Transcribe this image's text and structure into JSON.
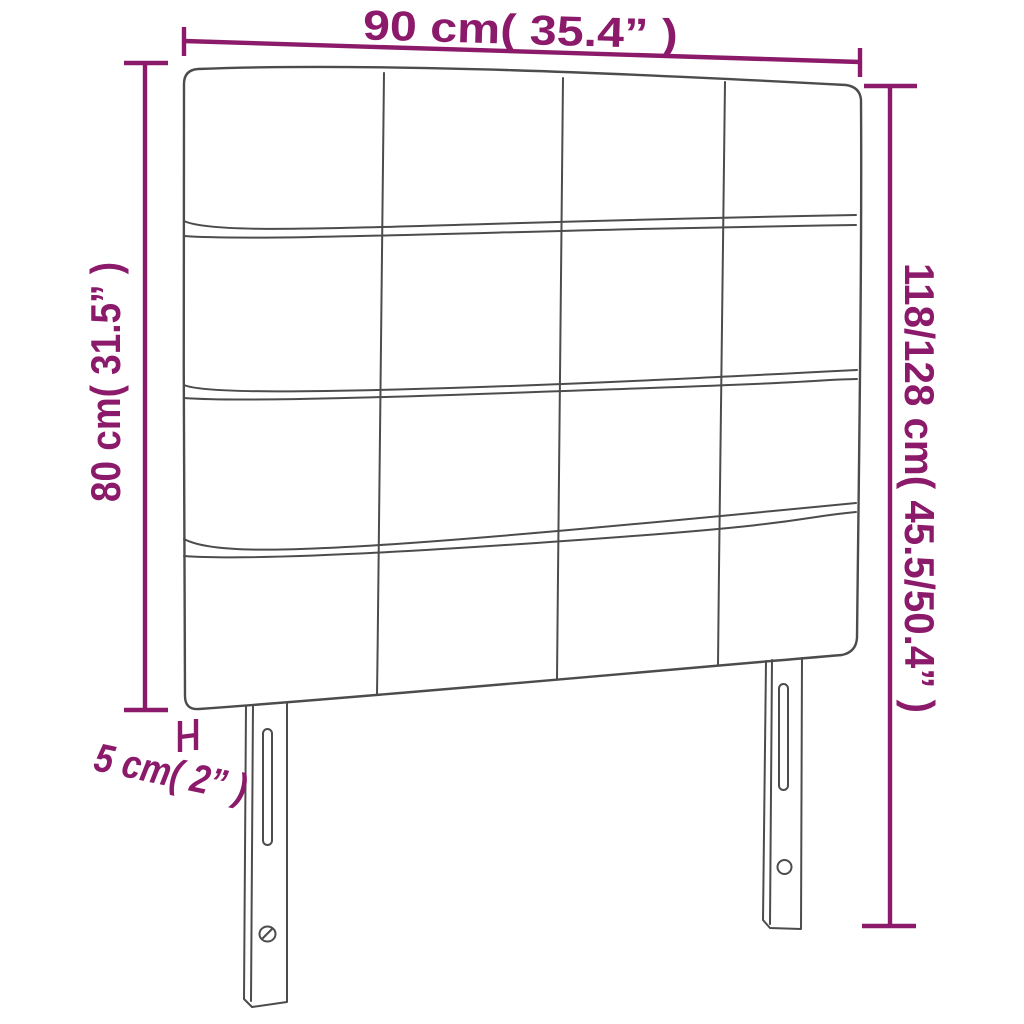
{
  "diagram": {
    "type": "product-dimension-diagram",
    "subject": "upholstered-headboard",
    "structure": {
      "panel_rows": 4,
      "panel_columns": 4,
      "legs": 2
    },
    "dimensions": {
      "width": {
        "label": "90 cm( 35.4” )"
      },
      "height_headboard": {
        "label": "80 cm( 31.5” )"
      },
      "height_total": {
        "label": "118/128 cm( 45.5/50.4” )"
      },
      "depth": {
        "label": "5 cm( 2” )"
      }
    }
  },
  "colors": {
    "dimension": "#8C1A6A",
    "outline": "#4C4C4C",
    "background": "#FFFFFF"
  }
}
